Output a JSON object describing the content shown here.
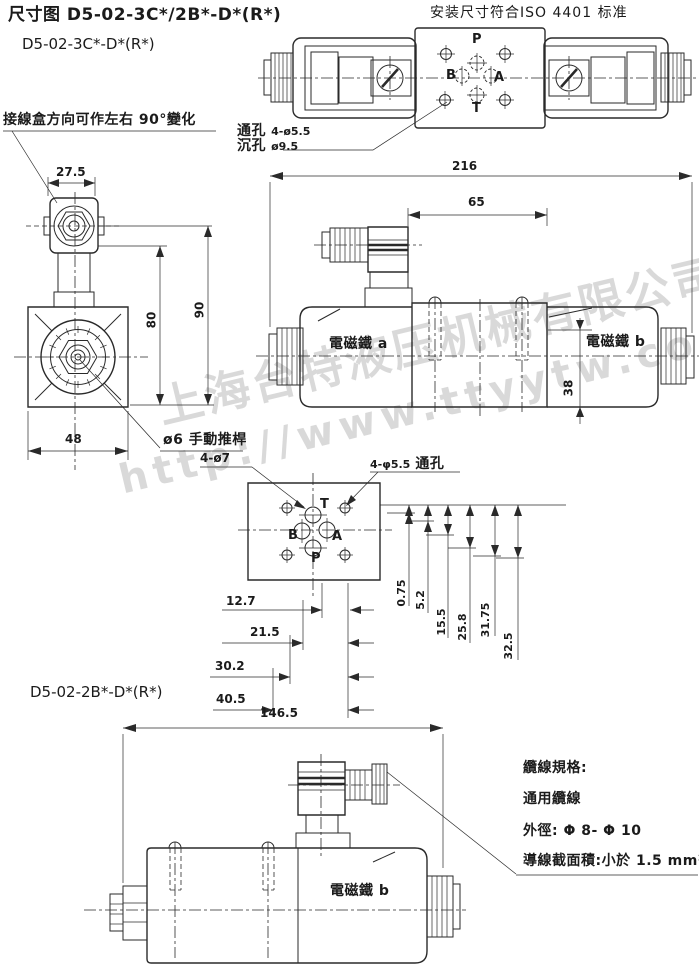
{
  "header": {
    "title": "尺寸图 D5-02-3C*/2B*-D*(R*)",
    "subtitle": "D5-02-3C*-D*(R*)",
    "standard_note": "安装尺寸符合ISO 4401 标准"
  },
  "watermark": {
    "company": "上海台特液压机械有限公司",
    "url": "http://www.ttyytw.com"
  },
  "top_view": {
    "port_p": "P",
    "port_a": "A",
    "port_b": "B",
    "port_t": "T",
    "through_hole_label": "通孔",
    "through_hole_value": "4-ø5.5",
    "counterbore_label": "沉孔",
    "counterbore_value": "ø9.5"
  },
  "side_view": {
    "junction_box_note": "接線盒方向可作左右 90°變化",
    "dim_top_width": "27.5",
    "dim_height_80": "80",
    "dim_height_90": "90",
    "dim_body_width": "48",
    "manual_override_note": "ø6 手動推桿"
  },
  "front_view": {
    "dim_overall_length": "216",
    "dim_connector_span": "65",
    "dim_body_height": "38",
    "solenoid_a": "電磁鐵 a",
    "solenoid_b": "電磁鐵 b"
  },
  "subplate": {
    "port_holes_note": "4-ø7",
    "through_holes_value": "4-φ5.5",
    "through_holes_label": "通孔",
    "port_p": "P",
    "port_a": "A",
    "port_b": "B",
    "port_t": "T",
    "dims_horizontal": [
      "12.7",
      "21.5",
      "30.2",
      "40.5"
    ],
    "dims_vertical": [
      "0.75",
      "5.2",
      "15.5",
      "25.8",
      "31.75",
      "32.5"
    ]
  },
  "bottom_view": {
    "model": "D5-02-2B*-D*(R*)",
    "dim_overall_length": "146.5",
    "solenoid_b": "電磁鐵 b"
  },
  "cable_spec": {
    "title": "纜線規格:",
    "line_cable": "通用纜線",
    "line_od": "外徑: Φ 8- Φ 10",
    "line_section": "導線截面積:小於 1.5 mm²"
  }
}
